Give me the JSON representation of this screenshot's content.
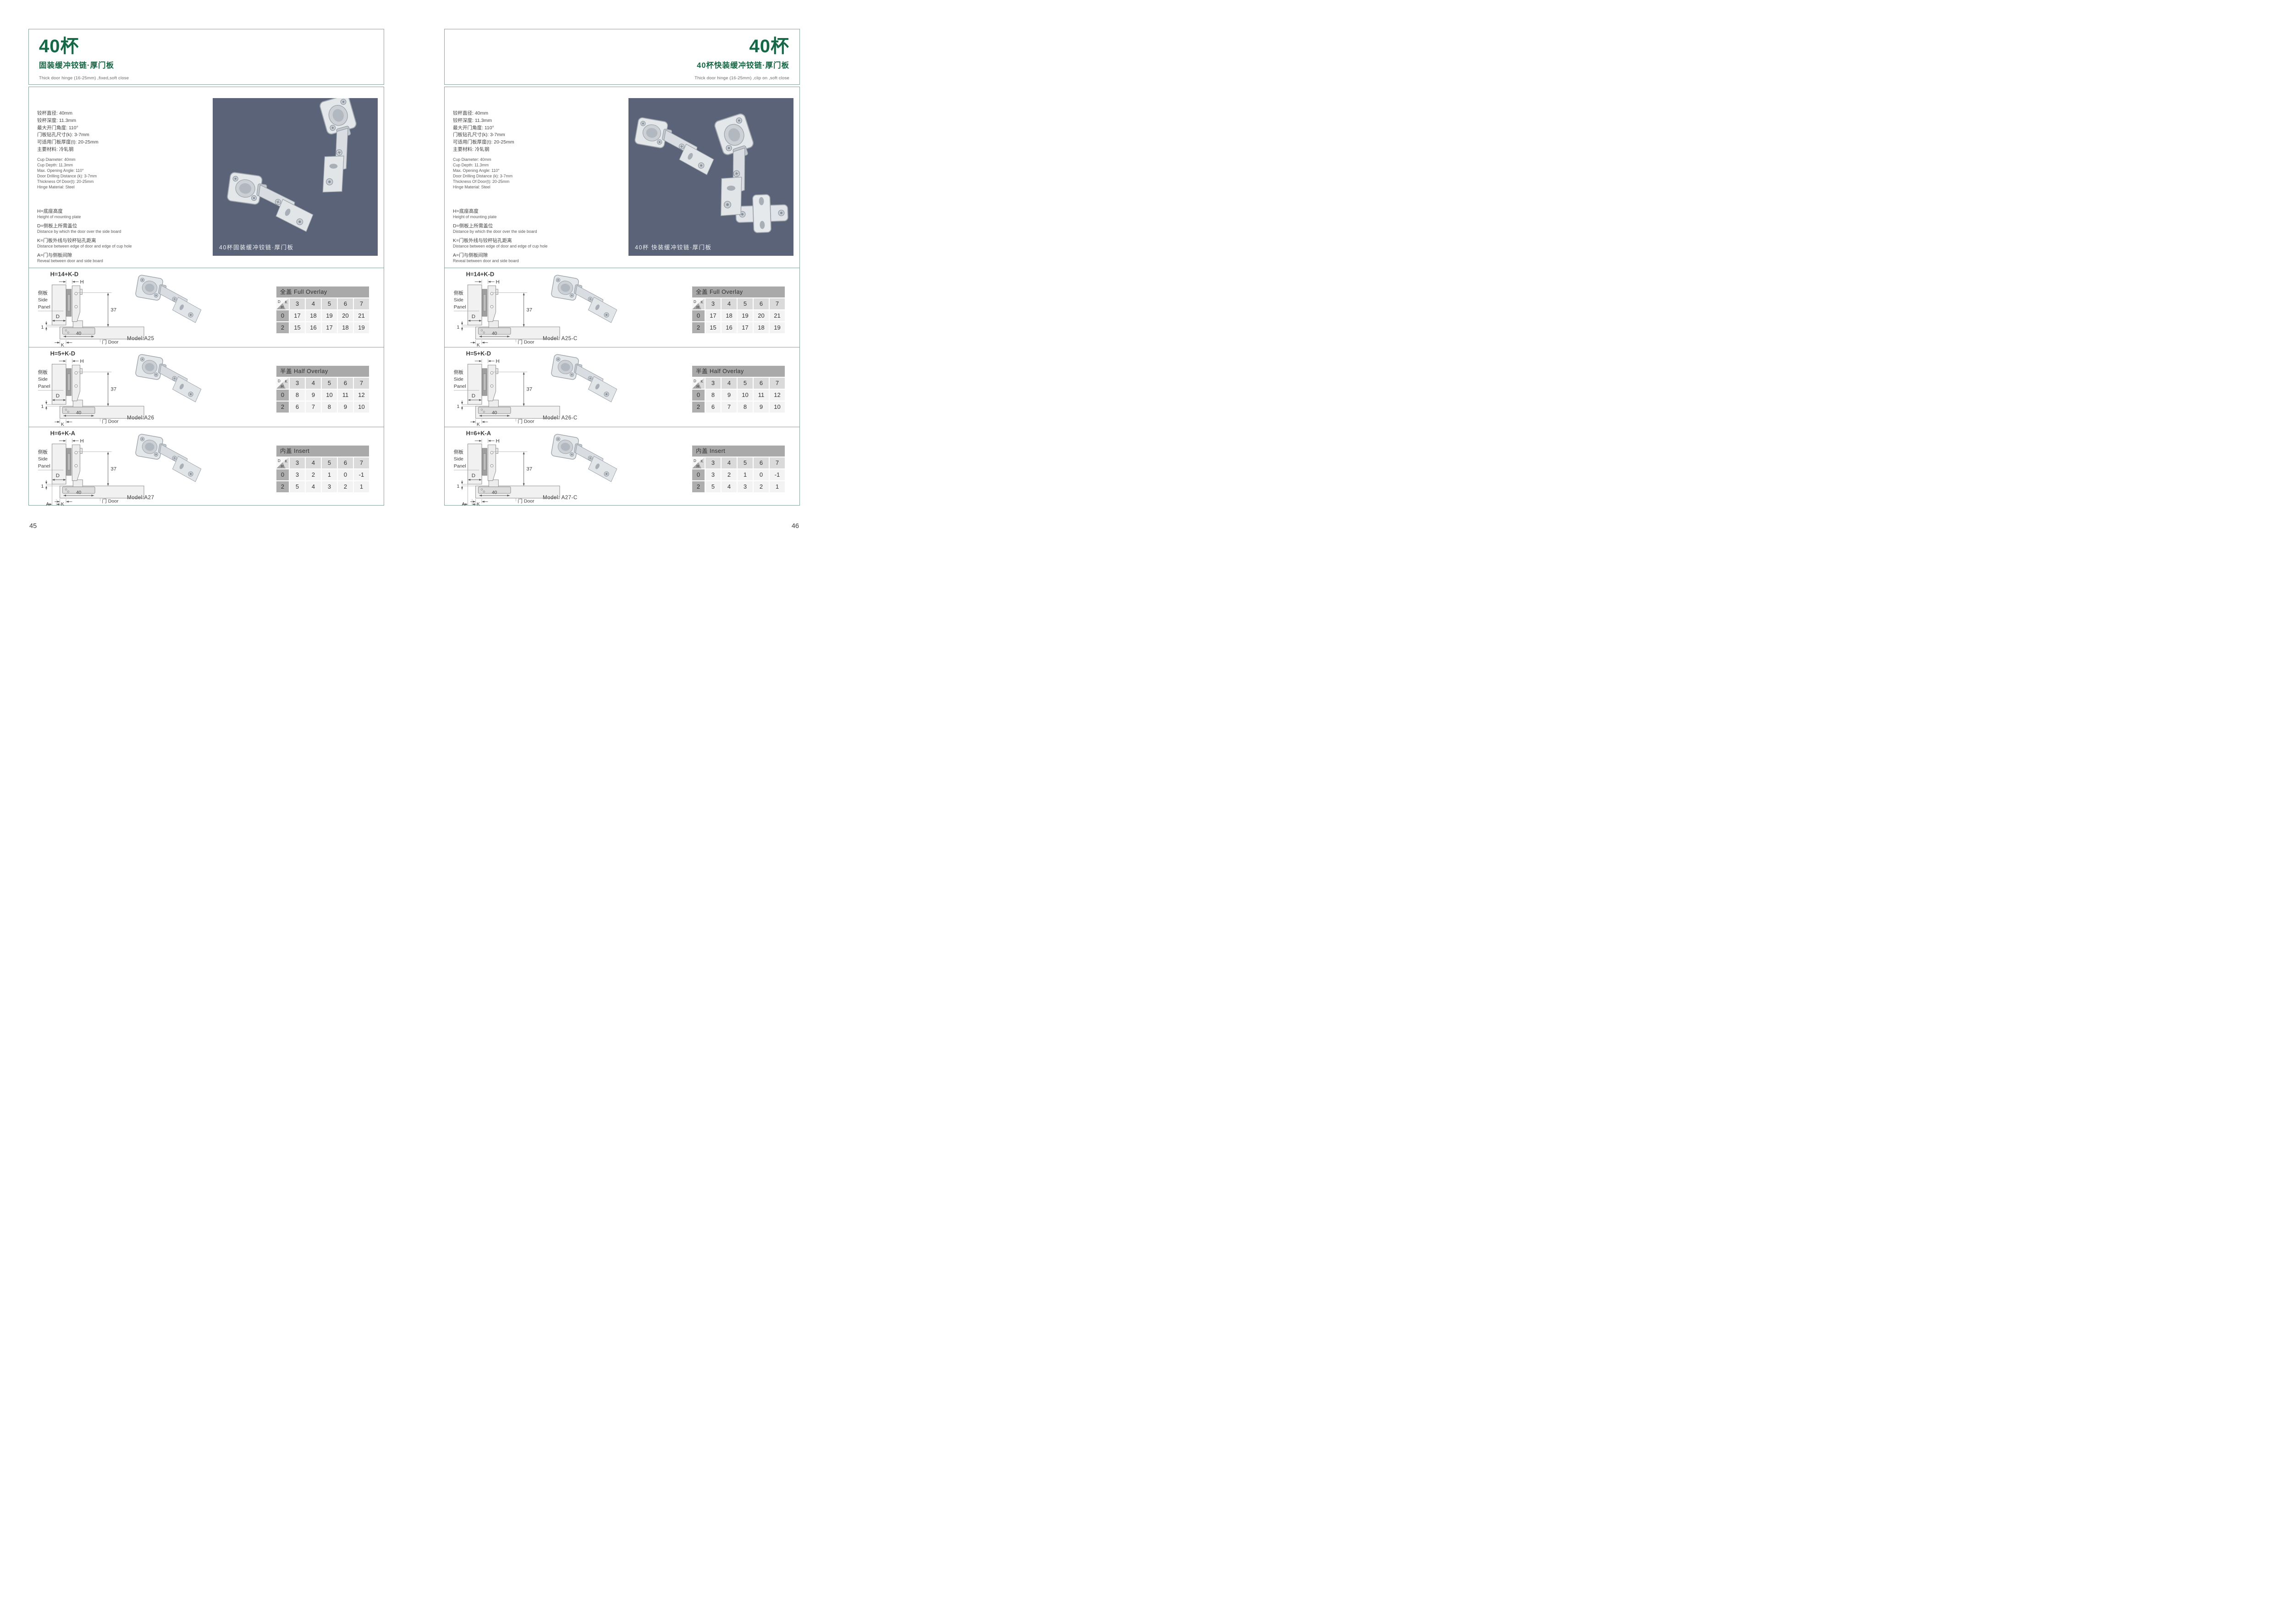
{
  "colors": {
    "accent_green": "#156845",
    "frame_line": "#83a293",
    "photo_background": "#5a6377",
    "table_title_bar": "#a9a9a9",
    "table_col_header": "#dadada",
    "table_row_header": "#aeaeae",
    "table_cell": "#f3f3f3"
  },
  "diagram": {
    "labels": {
      "h": "H",
      "d": "D",
      "k": "K",
      "a": "A",
      "one": "1",
      "forty": "40",
      "thirty_seven": "37",
      "side_panel_cn": "侧板",
      "side_panel_en_1": "Side",
      "side_panel_en_2": "Panel",
      "door": "门 Door"
    }
  },
  "pages": [
    {
      "side": "left",
      "page_number": "45",
      "title": "40杯",
      "subtitle": "固装缓冲铰链·厚门板",
      "subtitle_en": "Thick door hinge (16-25mm)  ,fixed,soft close",
      "specs_cn": [
        "铰杯直径: 40mm",
        "铰杯深度: 11.3mm",
        "最大开门角度: 110°",
        "门板钻孔尺寸(k): 3-7mm",
        "可适用门板厚度(t): 20-25mm",
        "主要材料: 冷轧钢"
      ],
      "specs_en": [
        "Cup Diameter: 40mm",
        "Cup Depth: 11.3mm",
        "Max. Opening Angle: 110°",
        "Door Drilling Distance (k): 3-7mm",
        "Thickness Of Door(t): 20-25mm",
        "Hinge Material: Steel"
      ],
      "legend": [
        {
          "cn": "H=底座高度",
          "en": "Height of mounting plate"
        },
        {
          "cn": "D=侧板上所需盖位",
          "en": "Distance by which the door over the side board"
        },
        {
          "cn": "K=门板外线与铰杯钻孔距离",
          "en": "Distance between edge of door and edge of cup hole"
        },
        {
          "cn": "A=门与侧板间隙",
          "en": "Reveal between door and side board"
        }
      ],
      "photo_caption": "40杯固装缓冲铰链·厚门板",
      "sections": [
        {
          "formula": "H=14+K-D",
          "model": "Model:A25",
          "show_a": false,
          "table": {
            "title": "全盖 Full Overlay",
            "corner": {
              "d": "D",
              "k": "K",
              "h": "H"
            },
            "columns": [
              "3",
              "4",
              "5",
              "6",
              "7"
            ],
            "rows": [
              {
                "h": "0",
                "values": [
                  "17",
                  "18",
                  "19",
                  "20",
                  "21"
                ]
              },
              {
                "h": "2",
                "values": [
                  "15",
                  "16",
                  "17",
                  "18",
                  "19"
                ]
              }
            ]
          }
        },
        {
          "formula": "H=5+K-D",
          "model": "Model:A26",
          "show_a": false,
          "table": {
            "title": "半盖 Half Overlay",
            "corner": {
              "d": "D",
              "k": "K",
              "h": "H"
            },
            "columns": [
              "3",
              "4",
              "5",
              "6",
              "7"
            ],
            "rows": [
              {
                "h": "0",
                "values": [
                  "8",
                  "9",
                  "10",
                  "11",
                  "12"
                ]
              },
              {
                "h": "2",
                "values": [
                  "6",
                  "7",
                  "8",
                  "9",
                  "10"
                ]
              }
            ]
          }
        },
        {
          "formula": "H=6+K-A",
          "model": "Model:A27",
          "show_a": true,
          "table": {
            "title": "内盖 Insert",
            "corner": {
              "d": "D",
              "k": "K",
              "h": "H"
            },
            "columns": [
              "3",
              "4",
              "5",
              "6",
              "7"
            ],
            "rows": [
              {
                "h": "0",
                "values": [
                  "3",
                  "2",
                  "1",
                  "0",
                  "-1"
                ]
              },
              {
                "h": "2",
                "values": [
                  "5",
                  "4",
                  "3",
                  "2",
                  "1"
                ]
              }
            ]
          }
        }
      ]
    },
    {
      "side": "right",
      "page_number": "46",
      "title": "40杯",
      "subtitle": "40杯快装缓冲铰链·厚门板",
      "subtitle_en": "Thick door hinge (16-25mm)  ,clip on ,soft close",
      "specs_cn": [
        "铰杯直径: 40mm",
        "铰杯深度: 11.3mm",
        "最大开门角度: 110°",
        "门板钻孔尺寸(k): 3-7mm",
        "可适用门板厚度(t): 20-25mm",
        "主要材料: 冷轧钢"
      ],
      "specs_en": [
        "Cup Diameter: 40mm",
        "Cup Depth: 11.3mm",
        "Max. Opening Angle: 110°",
        "Door Drilling Distance (k): 3-7mm",
        "Thickness Of Door(t): 20-25mm",
        "Hinge Material: Steel"
      ],
      "legend": [
        {
          "cn": "H=底座高度",
          "en": "Height of mounting plate"
        },
        {
          "cn": "D=侧板上所需盖位",
          "en": "Distance by which the door over the side board"
        },
        {
          "cn": "K=门板外线与铰杯钻孔距离",
          "en": "Distance between edge of door and edge of cup hole"
        },
        {
          "cn": "A=门与侧板间隙",
          "en": "Reveal between door and side board"
        }
      ],
      "photo_caption": "40杯 快装缓冲铰链·厚门板",
      "sections": [
        {
          "formula": "H=14+K-D",
          "model": "Model: A25-C",
          "show_a": false,
          "table": {
            "title": "全盖 Full Overlay",
            "corner": {
              "d": "D",
              "k": "K",
              "h": "H"
            },
            "columns": [
              "3",
              "4",
              "5",
              "6",
              "7"
            ],
            "rows": [
              {
                "h": "0",
                "values": [
                  "17",
                  "18",
                  "19",
                  "20",
                  "21"
                ]
              },
              {
                "h": "2",
                "values": [
                  "15",
                  "16",
                  "17",
                  "18",
                  "19"
                ]
              }
            ]
          }
        },
        {
          "formula": "H=5+K-D",
          "model": "Model: A26-C",
          "show_a": false,
          "table": {
            "title": "半盖 Half Overlay",
            "corner": {
              "d": "D",
              "k": "K",
              "h": "H"
            },
            "columns": [
              "3",
              "4",
              "5",
              "6",
              "7"
            ],
            "rows": [
              {
                "h": "0",
                "values": [
                  "8",
                  "9",
                  "10",
                  "11",
                  "12"
                ]
              },
              {
                "h": "2",
                "values": [
                  "6",
                  "7",
                  "8",
                  "9",
                  "10"
                ]
              }
            ]
          }
        },
        {
          "formula": "H=6+K-A",
          "model": "Model: A27-C",
          "show_a": true,
          "table": {
            "title": "内盖 Insert",
            "corner": {
              "d": "D",
              "k": "K",
              "h": "H"
            },
            "columns": [
              "3",
              "4",
              "5",
              "6",
              "7"
            ],
            "rows": [
              {
                "h": "0",
                "values": [
                  "3",
                  "2",
                  "1",
                  "0",
                  "-1"
                ]
              },
              {
                "h": "2",
                "values": [
                  "5",
                  "4",
                  "3",
                  "2",
                  "1"
                ]
              }
            ]
          }
        }
      ]
    }
  ]
}
